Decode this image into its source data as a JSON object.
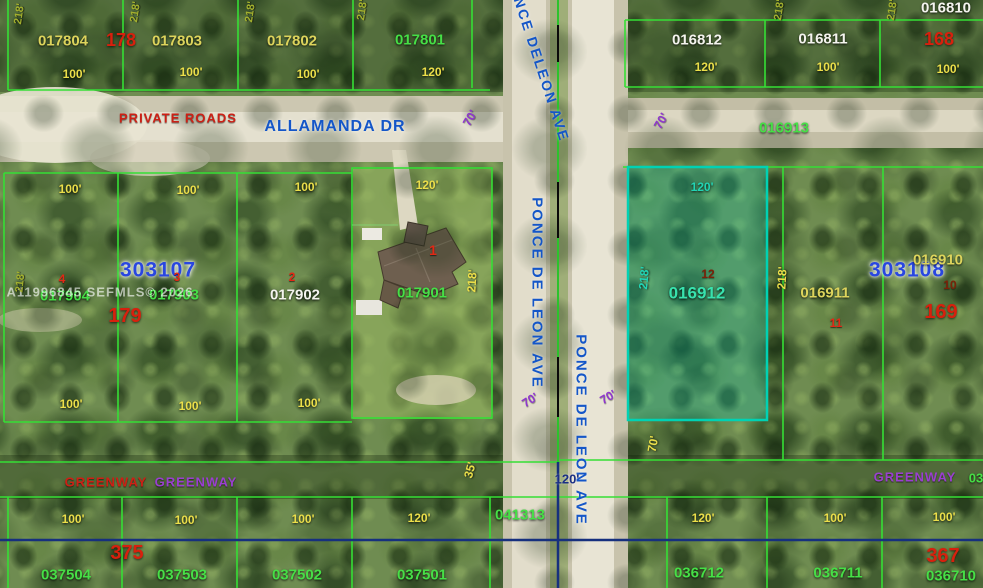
{
  "streets": {
    "allamanda": "ALLAMANDA DR",
    "private_roads": "PRIVATE ROADS",
    "ponce_top": "PONCE DELEON AVE",
    "ponce_mid": "PONCE DE LEON AVE",
    "ponce_right": "PONCE DE LEON AVE",
    "greenway_left_red": "GREENWAY",
    "greenway_left_purple": "GREENWAY",
    "greenway_right": "GREENWAY",
    "greenway_right_partial": "03"
  },
  "blocks": {
    "tl": "178",
    "tr": "168",
    "ml": "303107",
    "ml_num": "179",
    "mr": "303108",
    "mr_num": "169",
    "bl": "375",
    "br": "367"
  },
  "parcels": {
    "top_left": [
      "017804",
      "017803",
      "017802",
      "017801"
    ],
    "top_right": [
      "016812",
      "016811",
      "016810"
    ],
    "road_mid": "016913",
    "mid_left": [
      "017904",
      "017903",
      "017902",
      "017901"
    ],
    "mid_right": [
      "016912",
      "016911",
      "016910"
    ],
    "bottom_left": [
      "037504",
      "037503",
      "037502",
      "037501"
    ],
    "bottom_mid": "041313",
    "bottom_right": [
      "036712",
      "036711",
      "036710"
    ]
  },
  "lot_numbers": {
    "l1": "1",
    "l2": "2",
    "l3": "3",
    "l4": "4",
    "l10": "10",
    "l11": "11",
    "l12": "12"
  },
  "dims": {
    "d100": "100'",
    "d120": "120'",
    "d218": "218'",
    "d70": "70'",
    "d35": "35'"
  },
  "watermark": "A11996845 SEFMLS© 2026",
  "highlight": {
    "parcel_id": "016912",
    "border_color": "#00d2b4",
    "fill_color": "rgba(0,205,185,0.26)"
  },
  "palette": {
    "parcel_line_green": "#35df35",
    "street_blue": "#1456c8",
    "dim_yellow": "#ecdf4a",
    "block_red": "#d8200d",
    "greenway_purple": "#9a3fd0",
    "navy_line": "#16307e",
    "block_blue": "#2946e0",
    "highlight_teal": "#00d2b4"
  }
}
